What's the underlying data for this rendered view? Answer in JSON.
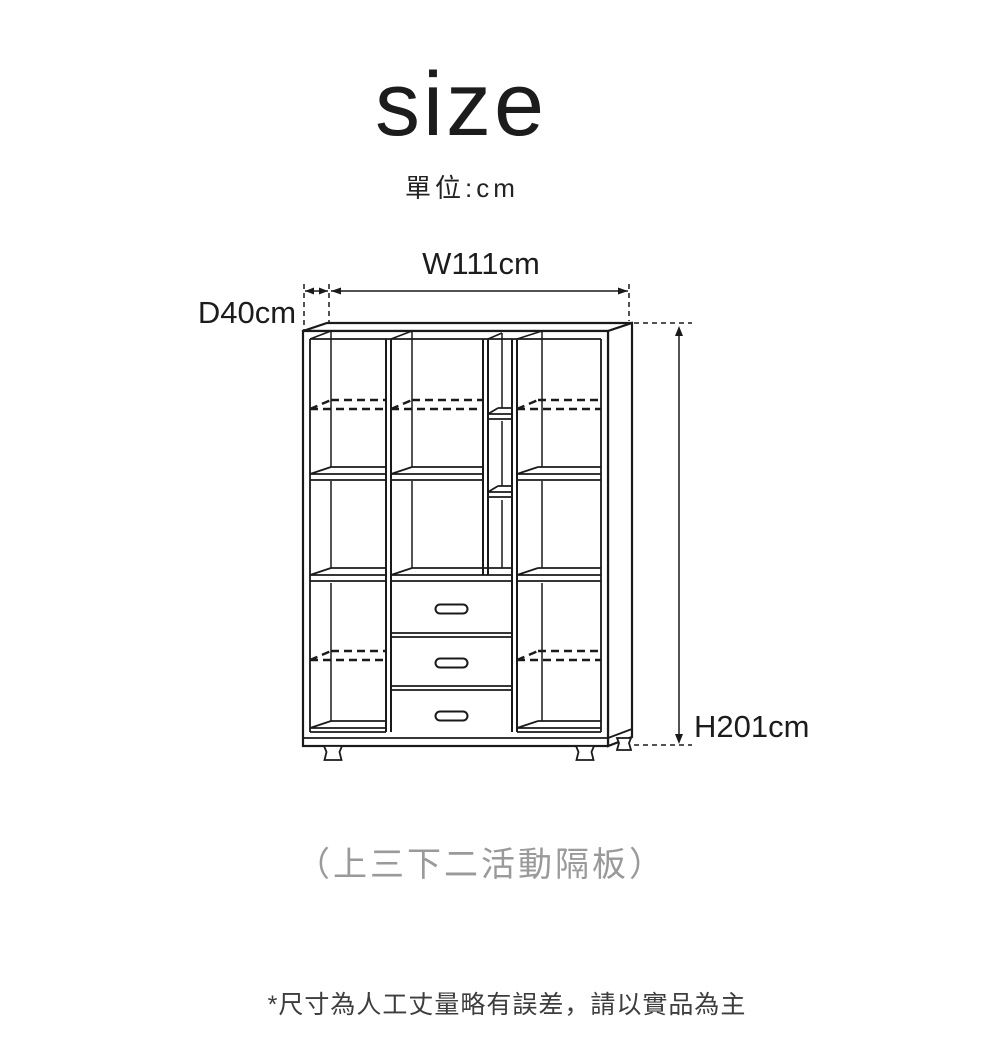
{
  "page": {
    "title": "size",
    "unit_label": "單位:cm",
    "caption": "（上三下二活動隔板）",
    "footnote": "*尺寸為人工丈量略有誤差，請以實品為主"
  },
  "dimensions": {
    "width_label": "W111cm",
    "depth_label": "D40cm",
    "height_label": "H201cm"
  },
  "figure": {
    "kind": "cabinet-dimension-diagram",
    "drawer_count": 3
  },
  "colors": {
    "background": "#ffffff",
    "line": "#1a1a1a",
    "text": "#1c1c1c",
    "caption_grey": "#9a9a9a",
    "footnote_grey": "#3d3d3d"
  }
}
